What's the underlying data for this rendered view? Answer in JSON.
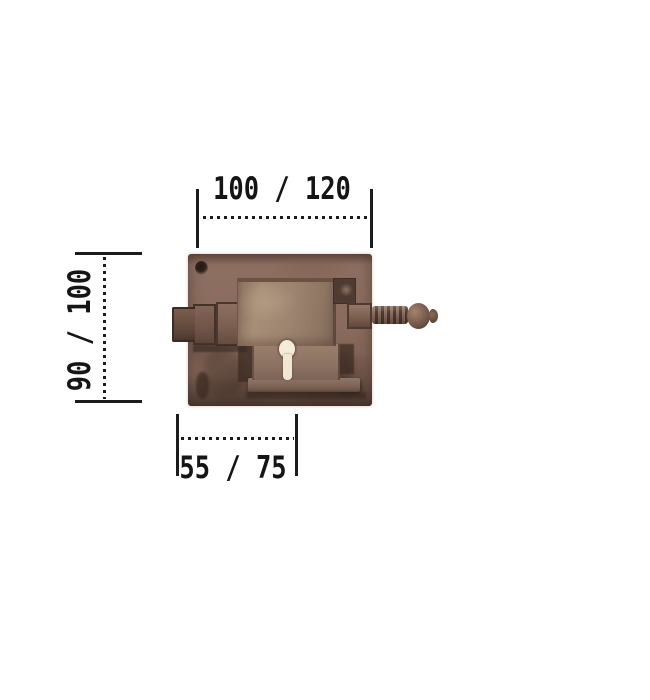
{
  "illustration": {
    "name": "antique-rim-lock-photo",
    "parts": [
      "base-plate",
      "screw-hole",
      "latch-bolt",
      "lock-case",
      "keyhole",
      "spindle-knob"
    ]
  },
  "dimensions": {
    "width": {
      "label": "100 / 120"
    },
    "height": {
      "label": "90 / 100"
    },
    "backset": {
      "label": "55 / 75"
    }
  },
  "colors": {
    "ink": "#1c1c1c",
    "background": "#ffffff",
    "plate": "#8a6b5e",
    "case": "#9c8470",
    "keyhole": "#f4ecd9"
  }
}
